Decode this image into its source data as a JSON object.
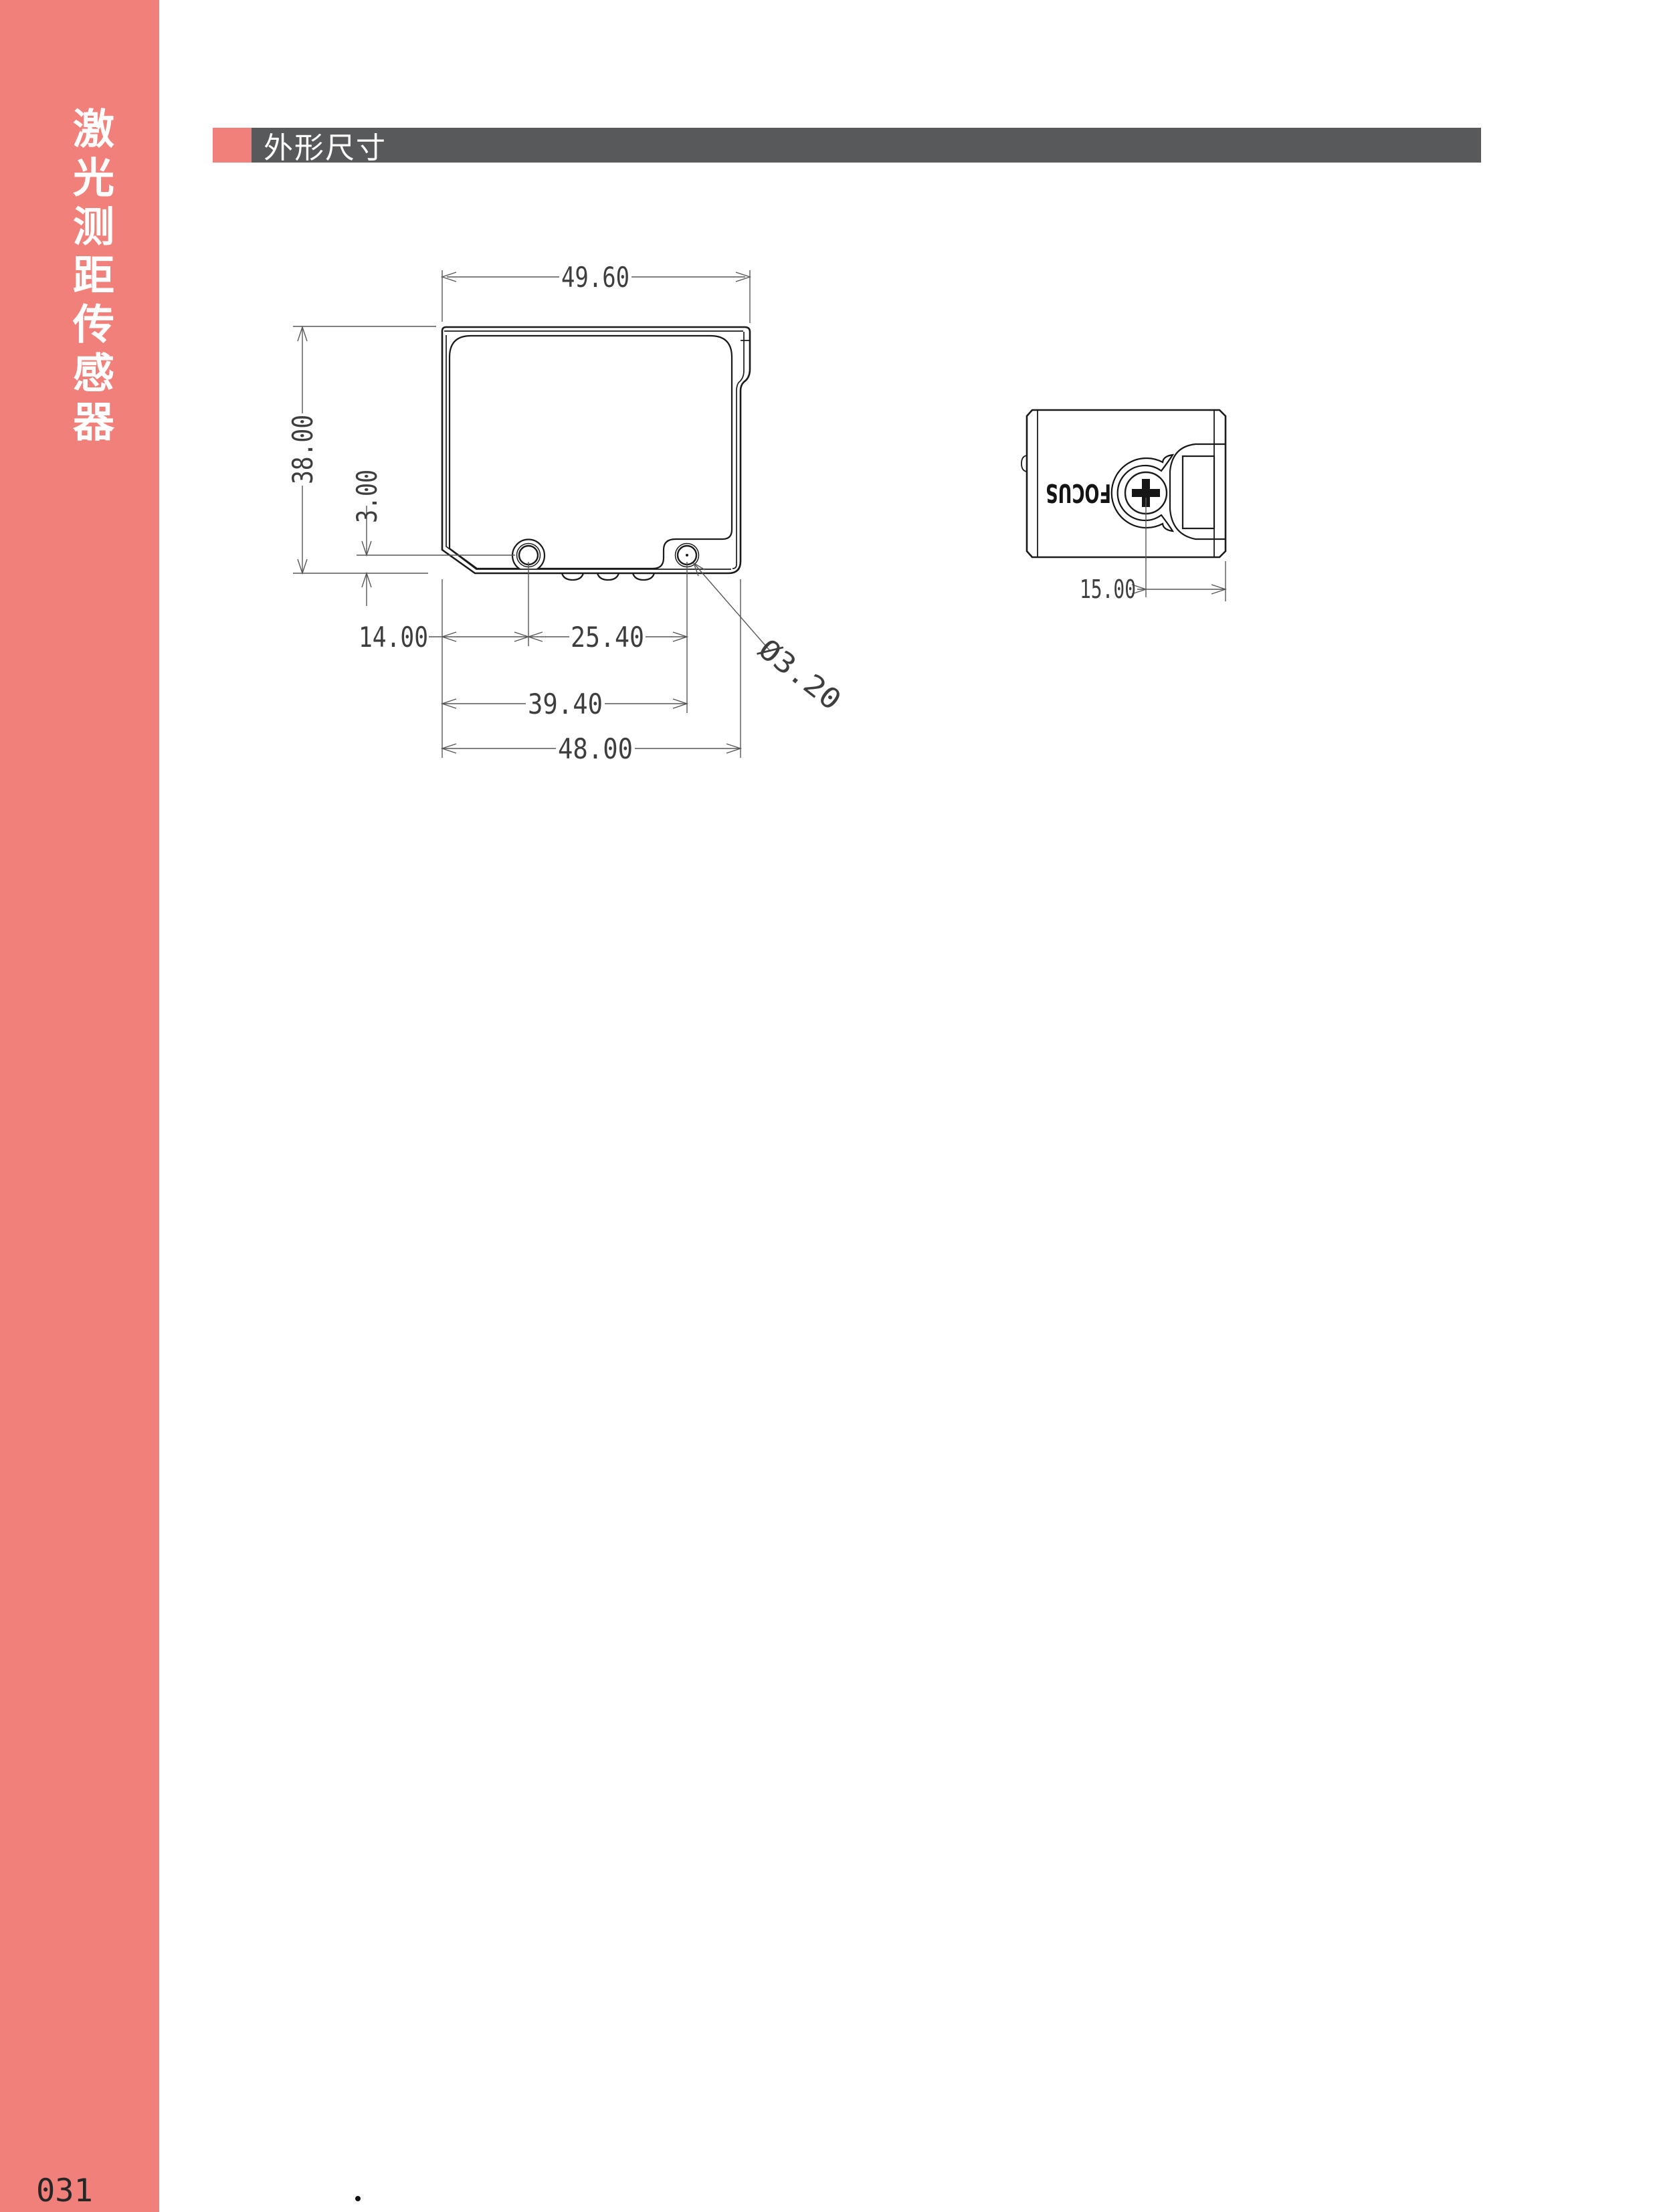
{
  "sidebar": {
    "title": "激光测距传感器",
    "page_number": "031",
    "color": "#f2807a"
  },
  "section_header": {
    "title": "外形尺寸",
    "bar_color": "#58595b",
    "accent_color": "#f2807a"
  },
  "drawing": {
    "front_view": {
      "dim_width_top": "49.60",
      "dim_height": "38.00",
      "dim_hole_to_bottom": "3.00",
      "dim_left_to_hole": "14.00",
      "dim_hole_spacing": "25.40",
      "dim_left_to_right_hole": "39.40",
      "dim_width_bottom": "48.00",
      "dim_hole_diameter": "Ø3.20"
    },
    "side_view": {
      "focus_label": "FOCUS",
      "dim_screw_to_edge": "15.00"
    }
  },
  "footer": {
    "dot": "."
  }
}
